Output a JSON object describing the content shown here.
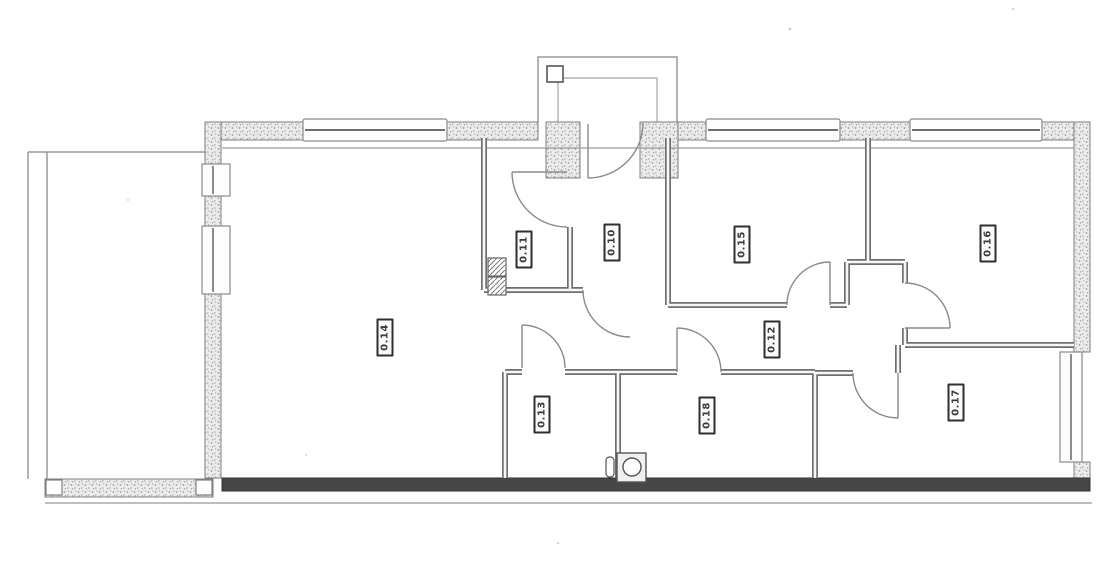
{
  "plan": {
    "rooms": [
      {
        "label": "0.14"
      },
      {
        "label": "0.11"
      },
      {
        "label": "0.10"
      },
      {
        "label": "0.15"
      },
      {
        "label": "0.16"
      },
      {
        "label": "0.12"
      },
      {
        "label": "0.13"
      },
      {
        "label": "0.18"
      },
      {
        "label": "0.17"
      }
    ],
    "fixtures": [
      {
        "icon": "toilet-icon"
      },
      {
        "icon": "hatched-shaft-icon"
      }
    ],
    "colors": {
      "background": "#ffffff",
      "exterior_wall_fill": "#ececec",
      "exterior_wall_speckle": "#9b9b9b",
      "dark_base_wall": "#474747",
      "wall_line": "#6f6f6f",
      "thin_line": "#8a8a8a",
      "label_border": "#2f2f2f"
    }
  }
}
